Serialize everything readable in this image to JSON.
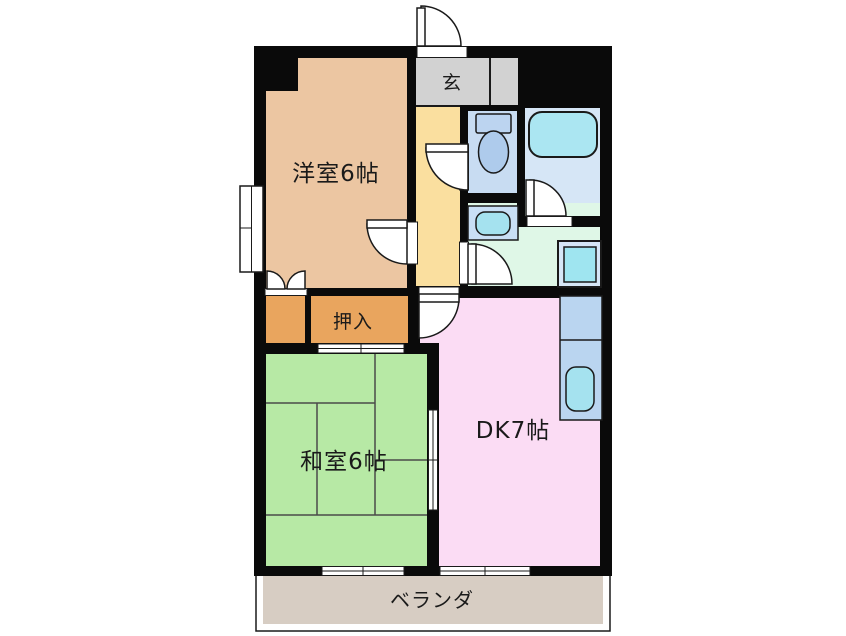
{
  "labels": {
    "western_room": "洋室6帖",
    "entrance": "玄",
    "closet": "押入",
    "japanese_room": "和室6帖",
    "dining_kitchen": "DK7帖",
    "veranda": "ベランダ"
  },
  "colors": {
    "wall": "#0a0a0a",
    "western_room": "#ecc6a2",
    "closet": "#e9a55e",
    "japanese_room": "#b7e9a5",
    "tatami_line": "#4a4a4a",
    "dining_kitchen": "#fbdcf4",
    "hallway": "#fadf9f",
    "entrance_hall": "#d2d2d2",
    "storage": "#e8d7f6",
    "toilet_room": "#c8dcf2",
    "bathroom": "#d6e6f6",
    "bathtub": "#abe6f2",
    "washroom": "#dff7e7",
    "washing_machine": "#9fe5f0",
    "appliance_base": "#d6e6f6",
    "kitchen_counter": "#bad5f0",
    "sink": "#a5e2ef",
    "toilet_tank": "#bcd4f0",
    "toilet_bowl": "#aecbec",
    "vanity": "#c9dff5",
    "veranda": "#d7cdc3"
  }
}
